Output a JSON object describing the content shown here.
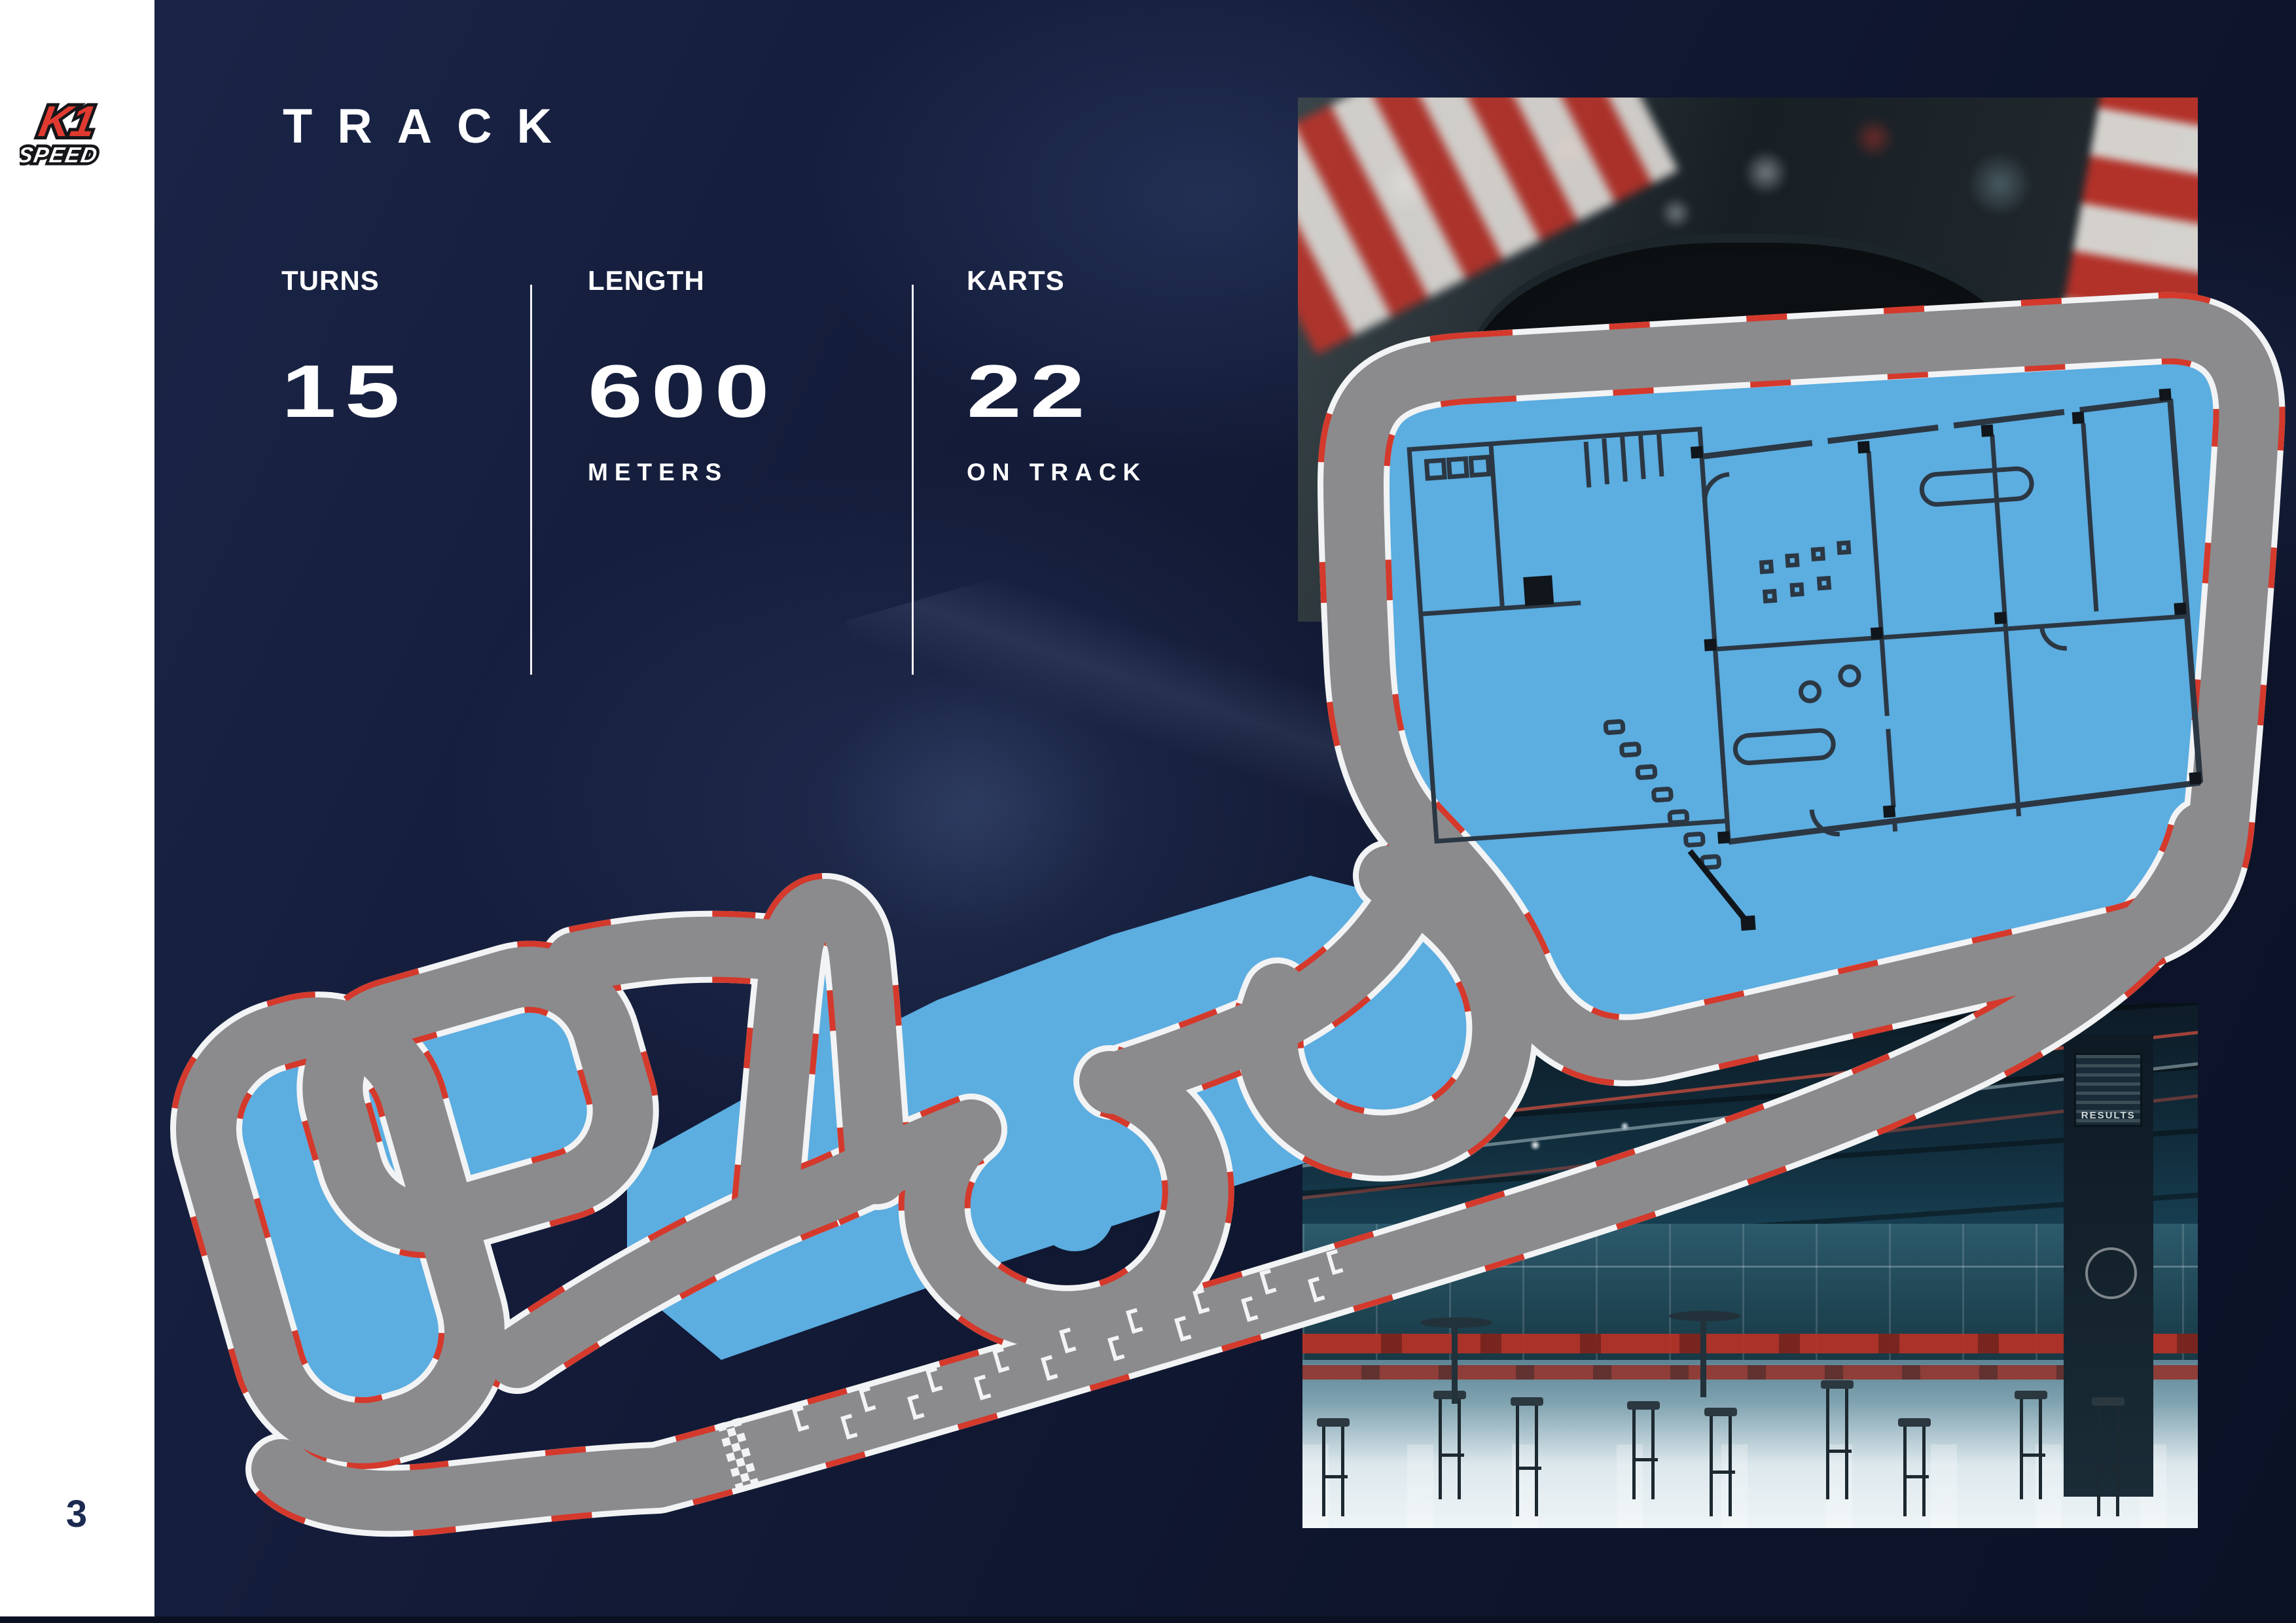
{
  "page": {
    "number": "3"
  },
  "sidebar": {
    "logo": {
      "k1": "K1",
      "speed": "SPEED"
    }
  },
  "header": {
    "title": "TRACK"
  },
  "stats": {
    "items": [
      {
        "label": "TURNS",
        "value": "15",
        "sub": ""
      },
      {
        "label": "LENGTH",
        "value": "600",
        "sub": "METERS"
      },
      {
        "label": "KARTS",
        "value": "22",
        "sub": "ON TRACK"
      }
    ]
  },
  "photos": {
    "top": {
      "name": "kart-closeup",
      "sticker_k1": "K1",
      "sticker_speed": "SPEED"
    },
    "bottom": {
      "name": "facility-interior",
      "screen_label": "RESULTS"
    }
  },
  "track_map": {
    "turns": 15,
    "length_meters": 600,
    "karts_on_track": 22,
    "colors": {
      "surface": "#8b8b8d",
      "edge": "#f2f3f4",
      "curb": "#d4392c",
      "infield": "#5cade0",
      "floorplan": "#2b3743",
      "background_navy": "#111830",
      "brand_red": "#e03a30"
    }
  }
}
